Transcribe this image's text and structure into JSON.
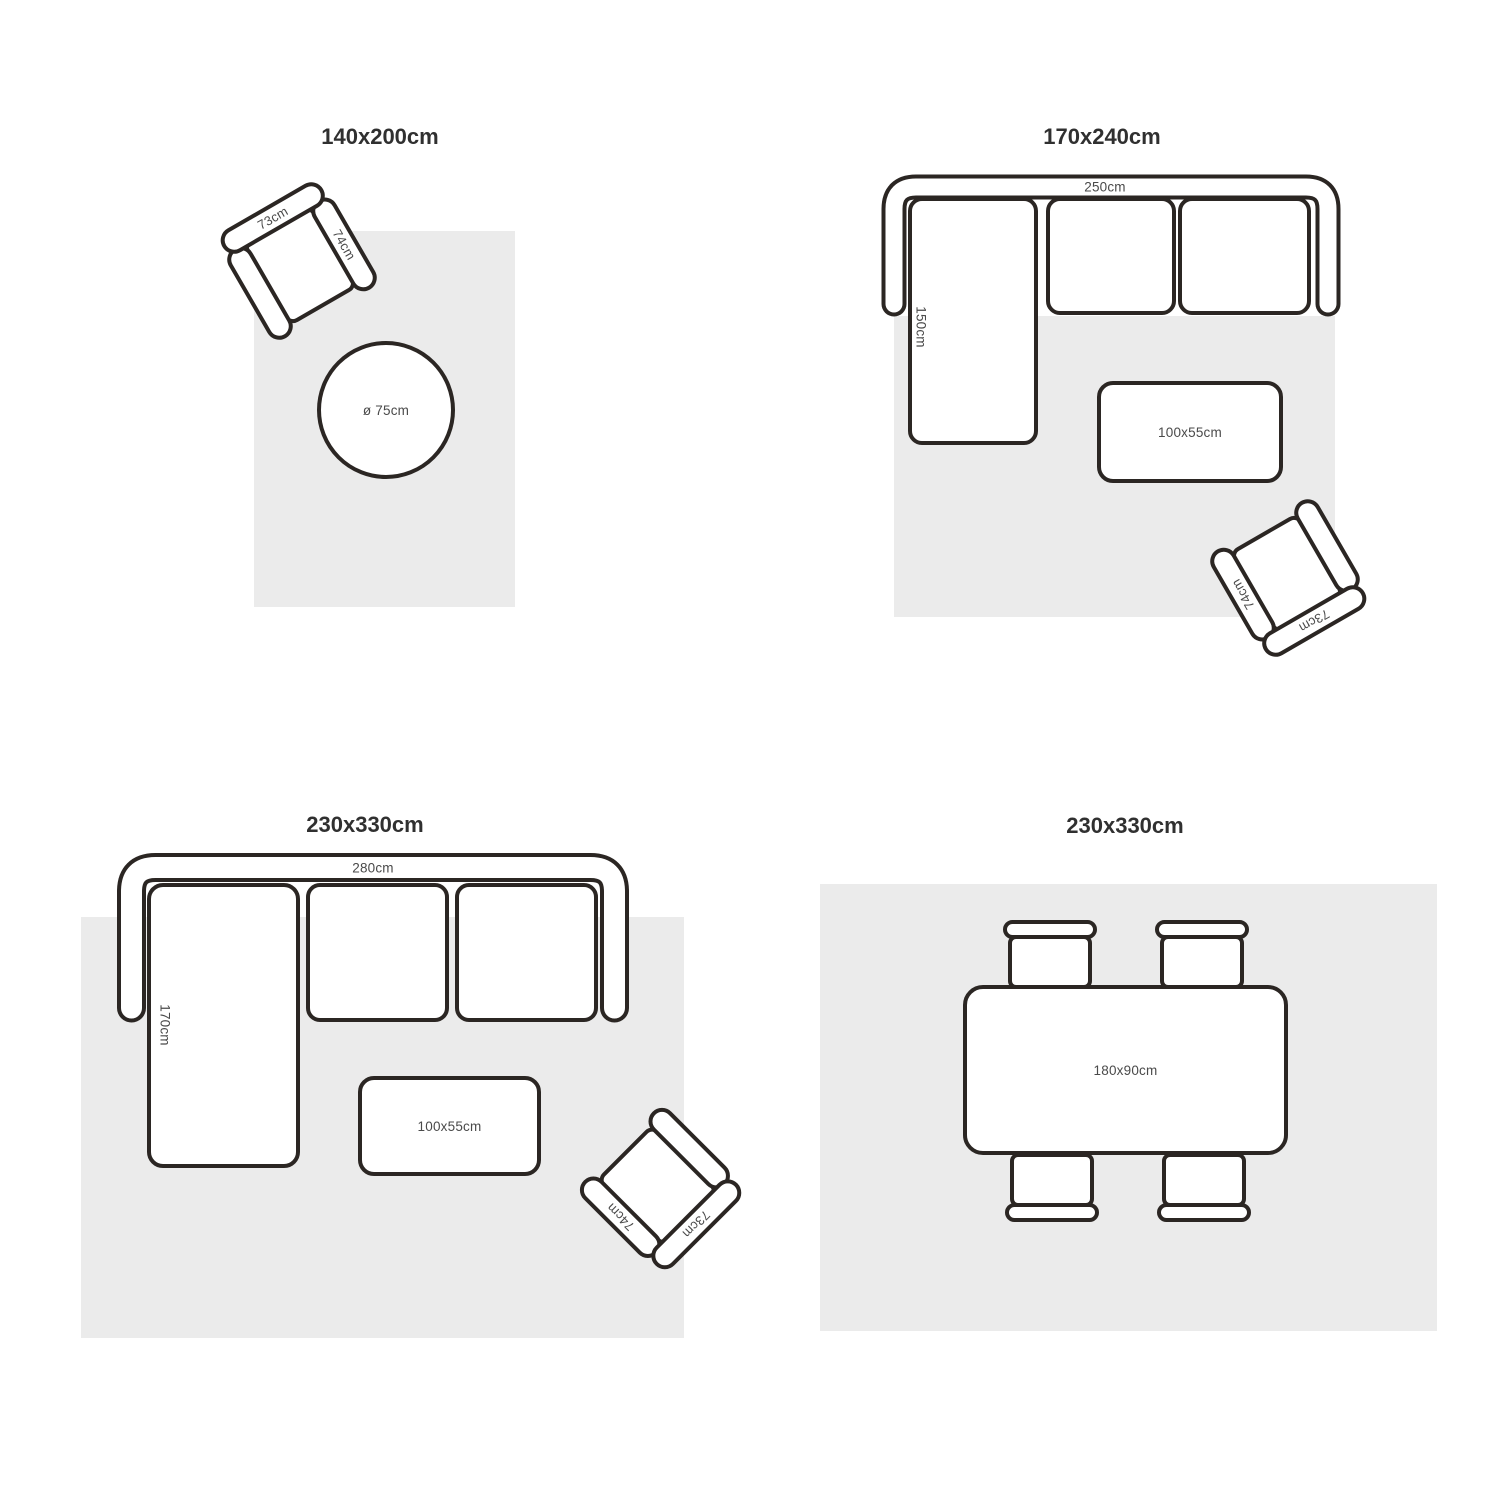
{
  "colors": {
    "outline": "#2b2623",
    "rug": "#ebebeb",
    "title_text": "#303030",
    "dimension_text": "#4a4a4a",
    "furniture_fill": "#ffffff"
  },
  "panels": [
    {
      "title": "140x200cm",
      "armchair": {
        "back_width": "73cm",
        "arm_depth": "74cm"
      },
      "round_table": {
        "diameter": "ø 75cm"
      }
    },
    {
      "title": "170x240cm",
      "sofa": {
        "width": "250cm",
        "chaise_depth": "150cm"
      },
      "coffee_table": {
        "size": "100x55cm"
      },
      "armchair": {
        "back_width": "73cm",
        "arm_depth": "74cm"
      }
    },
    {
      "title": "230x330cm",
      "sofa": {
        "width": "280cm",
        "chaise_depth": "170cm"
      },
      "coffee_table": {
        "size": "100x55cm"
      },
      "armchair": {
        "back_width": "73cm",
        "arm_depth": "74cm"
      }
    },
    {
      "title": "230x330cm",
      "dining_table": {
        "size": "180x90cm"
      }
    }
  ]
}
